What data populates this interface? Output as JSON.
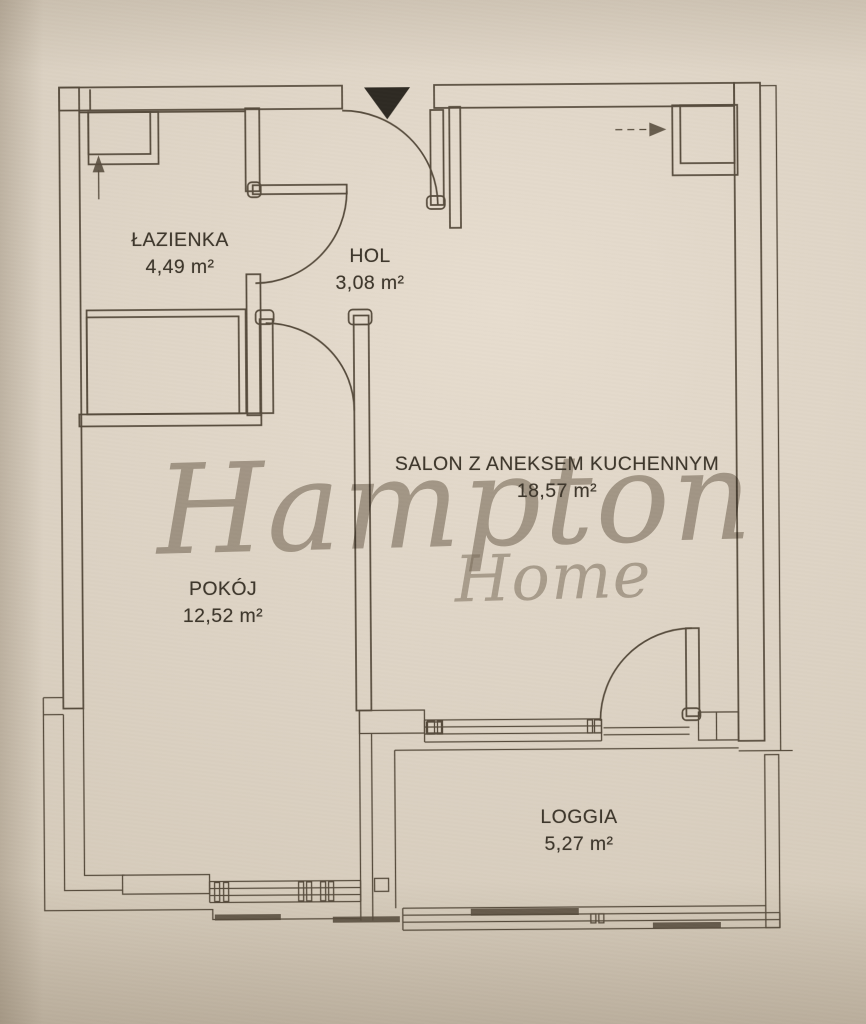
{
  "plan": {
    "rooms": [
      {
        "name": "ŁAZIENKA",
        "area": "4,49 m²"
      },
      {
        "name": "HOL",
        "area": "3,08 m²"
      },
      {
        "name": "SALON Z ANEKSEM KUCHENNYM",
        "area": "18,57 m²"
      },
      {
        "name": "POKÓJ",
        "area": "12,52 m²"
      },
      {
        "name": "LOGGIA",
        "area": "5,27 m²"
      }
    ],
    "watermark": {
      "line1": "Hampton",
      "line2": "Home"
    },
    "markers": {
      "entrance": "entrance-triangle-marker",
      "bathroom_arrow": "arrow-up-icon",
      "salon_arrow": "arrow-right-icon"
    },
    "colors": {
      "paper": "#dcd2c3",
      "line": "#564b3c",
      "text": "#3e372c",
      "watermark": "#8b8274",
      "entrance_marker": "#2e2a23"
    }
  }
}
